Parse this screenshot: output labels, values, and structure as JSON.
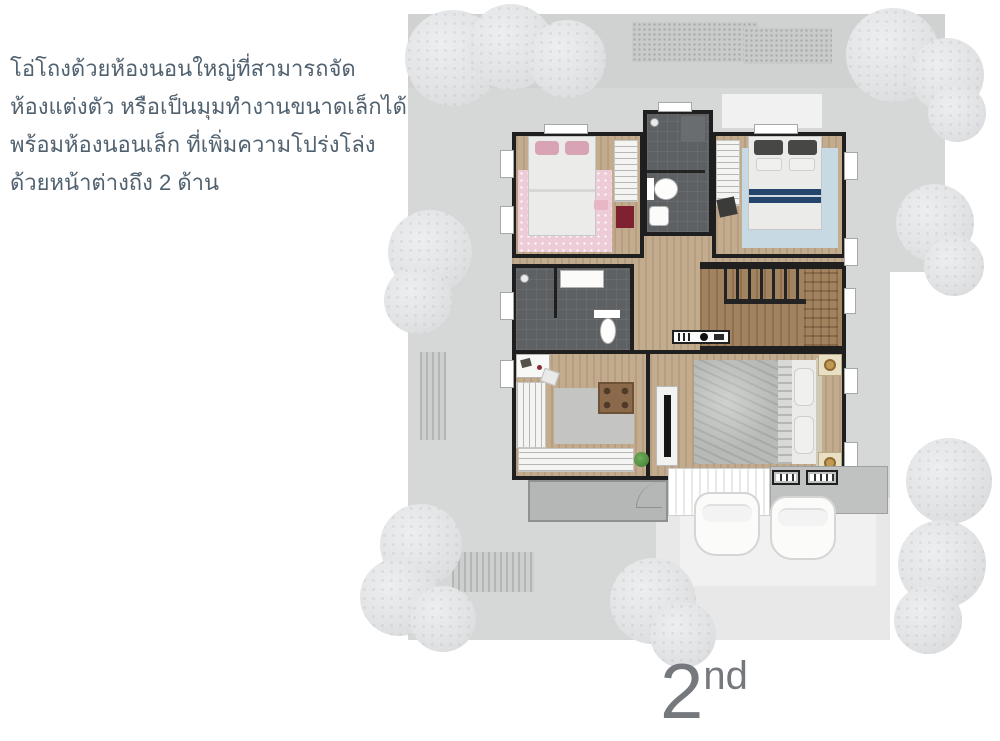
{
  "description": {
    "lines": [
      "โอ่โถงด้วยห้องนอนใหญ่ที่สามารถจัด",
      "ห้องแต่งตัว หรือเป็นมุมทำงานขนาดเล็กได้",
      "พร้อมห้องนอนเล็ก ที่เพิ่มความโปร่งโล่ง",
      "ด้วยหน้าต่างถึง 2 ด้าน"
    ]
  },
  "floor_label": {
    "number": "2",
    "suffix": "nd"
  },
  "theme": {
    "text-accent": "#50616f",
    "label-gray": "#75797d",
    "lot": "#d6d8d7",
    "lot-dark": "#d0d2d1",
    "wall": "#1f1f1f",
    "wood": "#c3ab8e",
    "bath": "#5e6163",
    "closet": "#f4f4f2",
    "pink-rug": "#edccd8",
    "blue-rug": "#c7dae3",
    "navy": "#24456b",
    "gray-bed": "#b7bab6",
    "stairs-wood": "#a2835f",
    "balcony": "#b5b7b6",
    "tree": "#e2e4e6",
    "car": "#fbfbfa",
    "gold": "#c09a52",
    "tan": "#e9dfc4",
    "drive": "#e7e8e7"
  }
}
